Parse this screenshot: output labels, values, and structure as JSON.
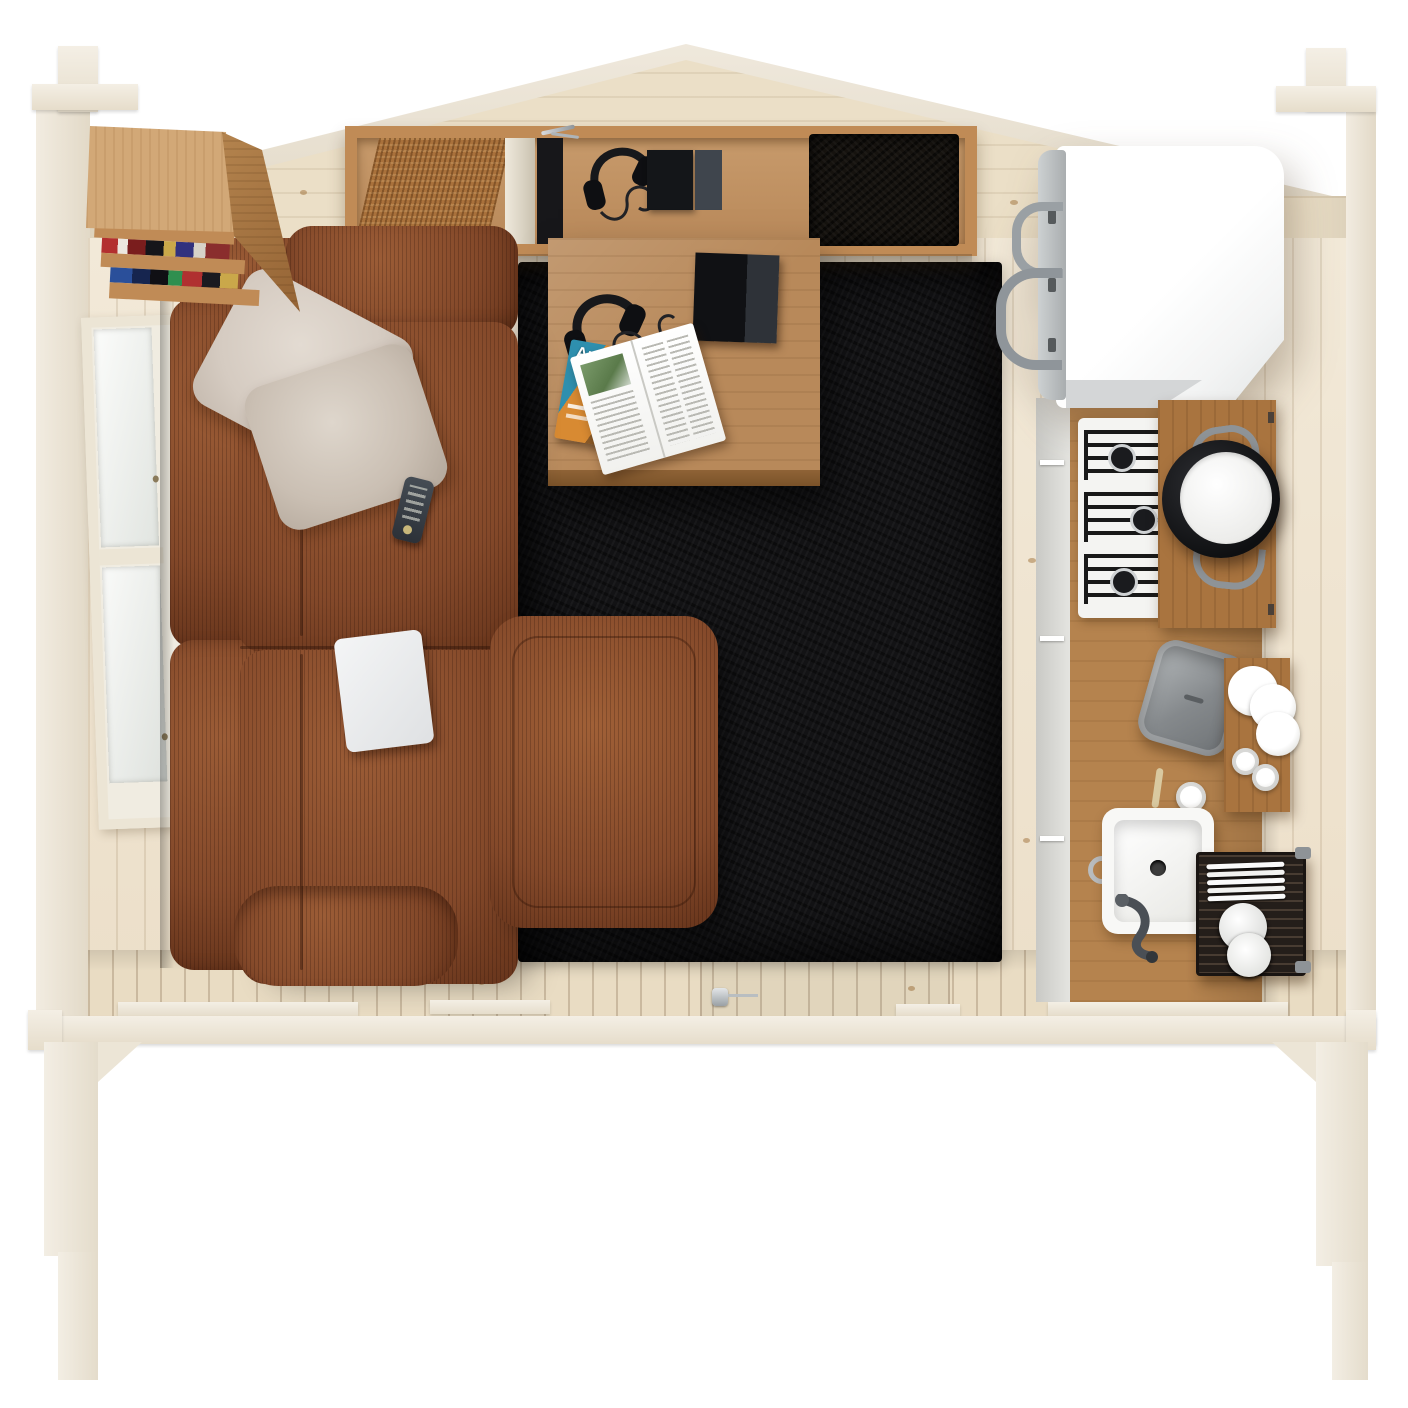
{
  "scene": {
    "title": "Log cabin interior, top-down cutaway view"
  },
  "magazine": {
    "title": "Arch"
  },
  "colors": {
    "bg": "#ffffff",
    "wood_outer": "#f2ece1",
    "wood_edge": "#e2d9c7",
    "pine": "#ebdfc7",
    "pine_dark": "#dfd2b5",
    "floor": "#f1e8d5",
    "front_band": "#e9dcc3",
    "oak_light": "#d2a877",
    "oak": "#c08b56",
    "oak_dark": "#a8763f",
    "table_oak": "#b8895a",
    "counter_oak": "#b5834e",
    "board_oak": "#a9743f",
    "rattan": "#a9713b",
    "sofa": "#84492a",
    "sofa_light": "#9b5c36",
    "sofa_dark": "#66341b",
    "pillow": "#d5cbc1",
    "rug": "#131315",
    "white_goods": "#fbfbfa",
    "silver": "#b3b8ba",
    "steel": "#85898c",
    "black": "#141519",
    "graphite": "#3a4047",
    "cover_teal": "#2e8fae",
    "cover_orange": "#d88a32",
    "leaf_green": "#5a7a4a"
  }
}
